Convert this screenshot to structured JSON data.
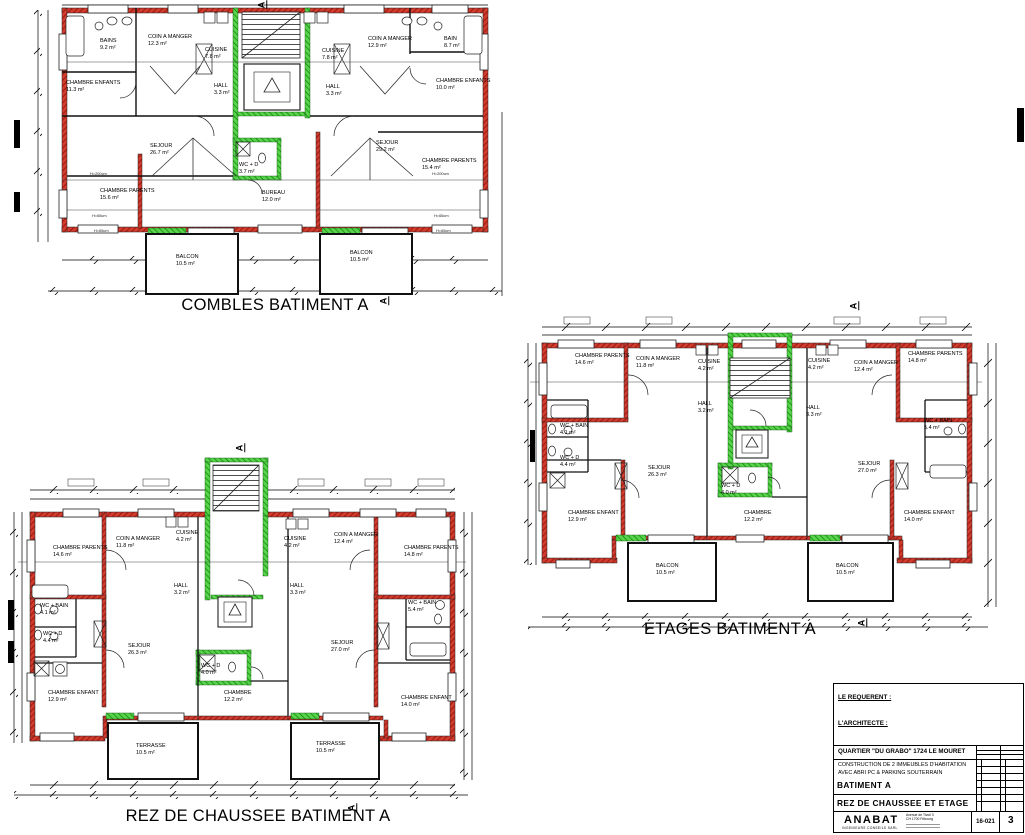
{
  "sheet": {
    "wall_red": "#d23b2e",
    "wall_green": "#57d44b",
    "line_black": "#111111"
  },
  "plans": {
    "combles": {
      "title": "COMBLES BATIMENT A",
      "section_marker": "A",
      "rooms": [
        {
          "text": "BAINS\n9.2 m²"
        },
        {
          "text": "COIN A MANGER\n12.3 m²"
        },
        {
          "text": "CUISINE\n7.8 m²"
        },
        {
          "text": "HALL\n3.3 m²"
        },
        {
          "text": "CHAMBRE ENFANTS\n11.3 m²"
        },
        {
          "text": "SEJOUR\n26.7 m²"
        },
        {
          "text": "CHAMBRE PARENTS\n15.6 m²"
        },
        {
          "text": "WC + D\n3.7 m²"
        },
        {
          "text": "BUREAU\n12.0 m²"
        },
        {
          "text": "BALCON\n10.5 m²"
        },
        {
          "text": "CUISINE\n7.8 m²"
        },
        {
          "text": "COIN A MANGER\n12.9 m²"
        },
        {
          "text": "BAIN\n8.7 m²"
        },
        {
          "text": "HALL\n3.3 m²"
        },
        {
          "text": "CHAMBRE ENFANTS\n10.0 m²"
        },
        {
          "text": "SEJOUR\n29.2 m²"
        },
        {
          "text": "CHAMBRE PARENTS\n15.4 m²"
        },
        {
          "text": "BALCON\n10.5 m²"
        }
      ],
      "height_labels": [
        "H=200cm",
        "H=65cm",
        "H=65cm",
        "H=200cm",
        "H=65cm",
        "H=65cm"
      ]
    },
    "etages": {
      "title": "ETAGES BATIMENT A",
      "section_marker": "A",
      "rooms": [
        {
          "text": "CHAMBRE PARENTS\n14.6 m²"
        },
        {
          "text": "COIN A MANGER\n11.8 m²"
        },
        {
          "text": "CUISINE\n4.2 m²"
        },
        {
          "text": "HALL\n3.2 m²"
        },
        {
          "text": "WC + BAIN\n4.1 m²"
        },
        {
          "text": "WC + D\n4.4 m²"
        },
        {
          "text": "SEJOUR\n26.3 m²"
        },
        {
          "text": "CHAMBRE ENFANT\n12.9 m²"
        },
        {
          "text": "BALCON\n10.5 m²"
        },
        {
          "text": "WC + D\n4.0 m²"
        },
        {
          "text": "CHAMBRE\n12.2 m²"
        },
        {
          "text": "CUISINE\n4.2 m²"
        },
        {
          "text": "COIN A MANGER\n12.4 m²"
        },
        {
          "text": "CHAMBRE PARENTS\n14.8 m²"
        },
        {
          "text": "HALL\n3.3 m²"
        },
        {
          "text": "WC + BAIN\n5.4 m²"
        },
        {
          "text": "SEJOUR\n27.0 m²"
        },
        {
          "text": "CHAMBRE ENFANT\n14.0 m²"
        },
        {
          "text": "BALCON\n10.5 m²"
        }
      ]
    },
    "rez": {
      "title": "REZ DE CHAUSSEE BATIMENT A",
      "section_marker": "A",
      "rooms": [
        {
          "text": "CHAMBRE PARENTS\n14.6 m²"
        },
        {
          "text": "COIN A MANGER\n11.8 m²"
        },
        {
          "text": "CUISINE\n4.2 m²"
        },
        {
          "text": "HALL\n3.2 m²"
        },
        {
          "text": "WC + BAIN\n4.1 m²"
        },
        {
          "text": "WC + D\n4.4 m²"
        },
        {
          "text": "SEJOUR\n26.3 m²"
        },
        {
          "text": "CHAMBRE ENFANT\n12.9 m²"
        },
        {
          "text": "TERRASSE\n10.5 m²"
        },
        {
          "text": "WC + D\n4.0 m²"
        },
        {
          "text": "CHAMBRE\n12.2 m²"
        },
        {
          "text": "CUISINE\n4.2 m²"
        },
        {
          "text": "COIN A MANGER\n12.4 m²"
        },
        {
          "text": "CHAMBRE PARENTS\n14.8 m²"
        },
        {
          "text": "HALL\n3.3 m²"
        },
        {
          "text": "WC + BAIN\n5.4 m²"
        },
        {
          "text": "SEJOUR\n27.0 m²"
        },
        {
          "text": "CHAMBRE ENFANT\n14.0 m²"
        },
        {
          "text": "TERRASSE\n10.5 m²"
        }
      ]
    }
  },
  "title_block": {
    "requerant_label": "LE REQUERENT :",
    "architecte_label": "L'ARCHITECTE :",
    "project_line1": "QUARTIER \"DU GRABO\" 1724 LE MOURET",
    "project_line2": "CONSTRUCTION DE 2 IMMEUBLES D'HABITATION",
    "project_line3": "AVEC ABRI PC & PARKING SOUTERRAIN",
    "batiment": "BATIMENT A",
    "sheet_title": "REZ DE CHAUSSEE ET ETAGE",
    "firm_name": "ANABAT",
    "firm_subtitle": "INGENIEURS CONSEILS SARL",
    "firm_address": "Avenue de Tivoli 3\nCH 1700 Fribourg",
    "doc_number": "16-021",
    "page_number": "3"
  }
}
